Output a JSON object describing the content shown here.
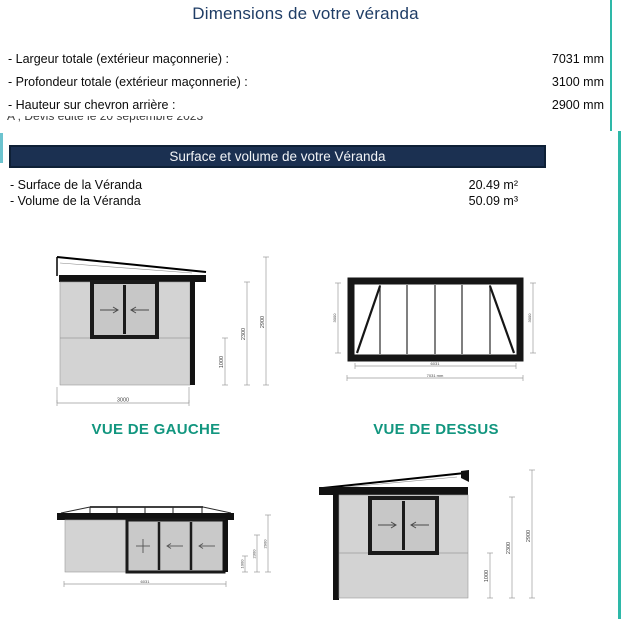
{
  "header": {
    "title": "Dimensions de votre véranda"
  },
  "dimensions": {
    "rows": [
      {
        "label": "- Largeur totale (extérieur maçonnerie) :",
        "value": "7031 mm"
      },
      {
        "label": "- Profondeur totale (extérieur maçonnerie) :",
        "value": "3100 mm"
      },
      {
        "label": "- Hauteur sur chevron arrière :",
        "value": "2900 mm"
      }
    ]
  },
  "clipped_note": {
    "text": "A , Devis édité le 20 septembre 2023"
  },
  "banner": {
    "title": "Surface et volume de votre Véranda"
  },
  "metrics": {
    "rows": [
      {
        "label": "- Surface de la Véranda",
        "value": "20.49 m²"
      },
      {
        "label": "- Volume de la Véranda",
        "value": "50.09 m³"
      }
    ]
  },
  "views": {
    "left": {
      "caption": "VUE DE GAUCHE",
      "dim_v1": "1000",
      "dim_v2": "2300",
      "dim_v3": "2900",
      "dim_bottom": "3000"
    },
    "top": {
      "caption": "VUE DE DESSUS",
      "dim_left": "3000",
      "dim_right": "3000",
      "dim_width_inner": "6031",
      "dim_width_outer": "7031 mm"
    },
    "front": {
      "dim_v1": "1000",
      "dim_v2": "2300",
      "dim_v3": "2900",
      "dim_bottom": "6031"
    },
    "right": {
      "dim_v1": "1000",
      "dim_v2": "2300",
      "dim_v3": "2900"
    }
  },
  "colors": {
    "accent_teal": "#2eb8a8",
    "caption_teal": "#12967f",
    "banner_navy": "#1b3051",
    "title_navy": "#1f3d66"
  }
}
